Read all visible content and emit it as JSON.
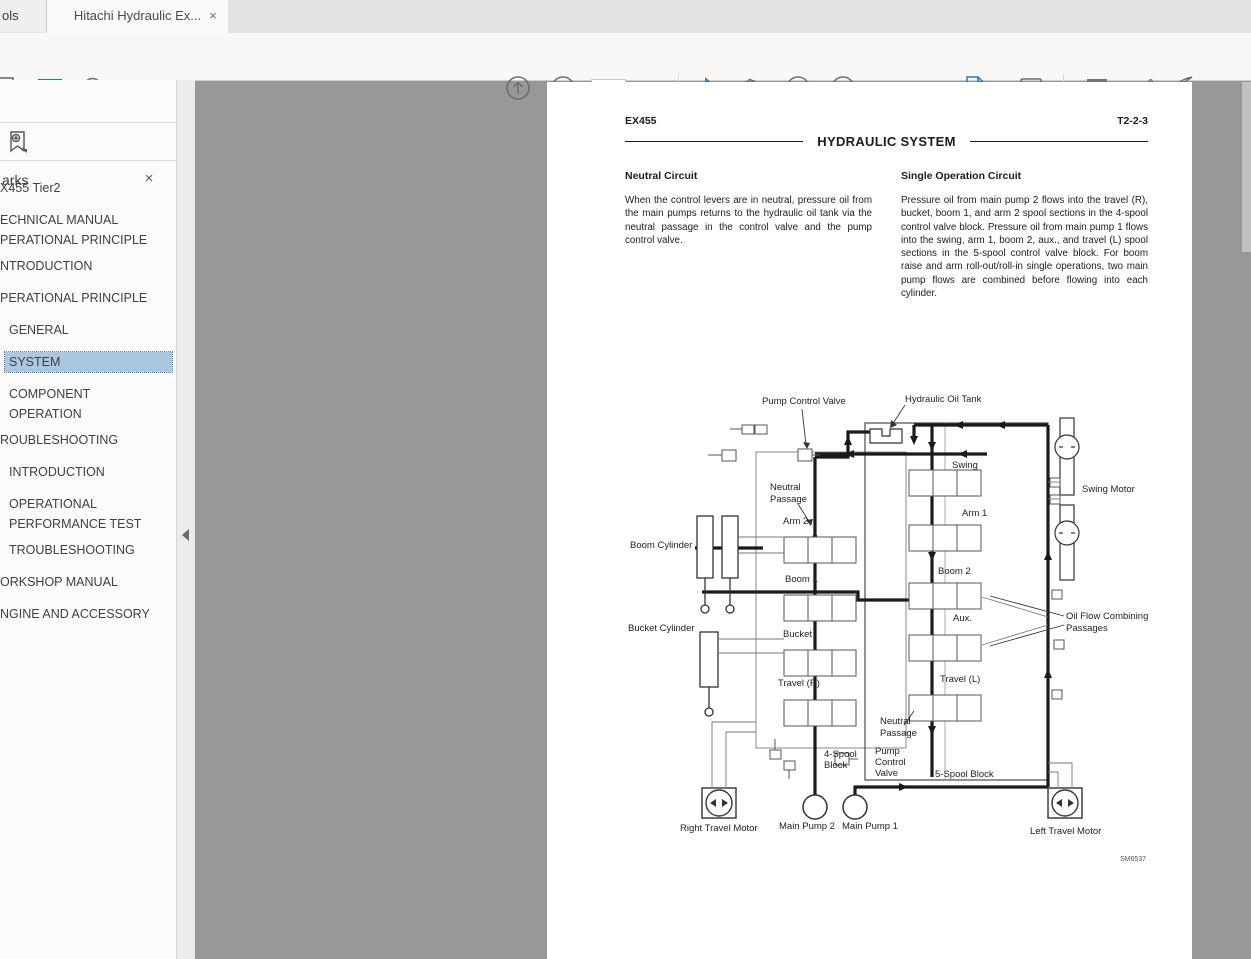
{
  "tab_bar": {
    "partial_tab_label": "ols",
    "active_tab_label": "Hitachi Hydraulic Ex...",
    "close_glyph": "×"
  },
  "toolbar": {
    "page_current": "49",
    "page_total": "/ 878",
    "zoom_value": "71.1%"
  },
  "bookmarks": {
    "title": "arks",
    "close_glyph": "×",
    "items": [
      {
        "label": "X455 Tier2"
      },
      {
        "label": "ECHNICAL MANUAL\nPERATIONAL PRINCIPLE"
      },
      {
        "label": "NTRODUCTION"
      },
      {
        "label": "PERATIONAL PRINCIPLE"
      },
      {
        "label": "GENERAL"
      },
      {
        "label": "SYSTEM",
        "selected": true
      },
      {
        "label": "COMPONENT\nOPERATION"
      },
      {
        "label": "ROUBLESHOOTING"
      },
      {
        "label": "INTRODUCTION"
      },
      {
        "label": "OPERATIONAL\nPERFORMANCE TEST"
      },
      {
        "label": "TROUBLESHOOTING"
      },
      {
        "label": "ORKSHOP MANUAL"
      },
      {
        "label": "NGINE AND ACCESSORY"
      }
    ]
  },
  "document": {
    "model": "EX455",
    "page_code": "T2-2-3",
    "section_title": "HYDRAULIC SYSTEM",
    "left": {
      "heading": "Neutral Circuit",
      "body": "When the control levers are in neutral, pressure oil from the main pumps returns to the hydraulic oil tank via the neutral passage in the control valve and the pump control valve."
    },
    "right": {
      "heading": "Single Operation Circuit",
      "body": "Pressure oil from main pump 2 flows into the travel (R), bucket, boom 1, and arm 2 spool sections in the 4-spool control valve block. Pressure oil from main pump 1 flows into the swing, arm 1, boom 2, aux., and travel (L) spool sections in the 5-spool control valve block. For boom raise and arm roll-out/roll-in single operations, two main pump flows are combined before flowing into each cylinder.",
      "figure_code": "SM6537"
    }
  },
  "diagram": {
    "pump_control_valve_top": "Pump Control Valve",
    "hydraulic_oil_tank": "Hydraulic Oil Tank",
    "neutral_top_1": "Neutral",
    "neutral_top_2": "Passage",
    "arm2": "Arm 2",
    "arm1": "Arm 1",
    "swing": "Swing",
    "swing_motor": "Swing Motor",
    "boom_cylinder": "Boom Cylinder",
    "boom1": "Boom 1",
    "boom2": "Boom 2",
    "bucket_cylinder": "Bucket Cylinder",
    "bucket": "Bucket",
    "aux": "Aux.",
    "travel_r": "Travel (R)",
    "travel_l": "Travel (L)",
    "oil_flow_1": "Oil Flow Combining",
    "oil_flow_2": "Passages",
    "neutral_bottom_1": "Neutral",
    "neutral_bottom_2": "Passage",
    "pcv_bottom_1": "Pump",
    "pcv_bottom_2": "Control",
    "pcv_bottom_3": "Valve",
    "four_spool_1": "4-Spool",
    "four_spool_2": "Block",
    "five_spool": "5-Spool Block",
    "right_travel_motor": "Right Travel Motor",
    "main_pump_2": "Main Pump 2",
    "main_pump_1": "Main Pump 1",
    "left_travel_motor": "Left Travel Motor"
  }
}
